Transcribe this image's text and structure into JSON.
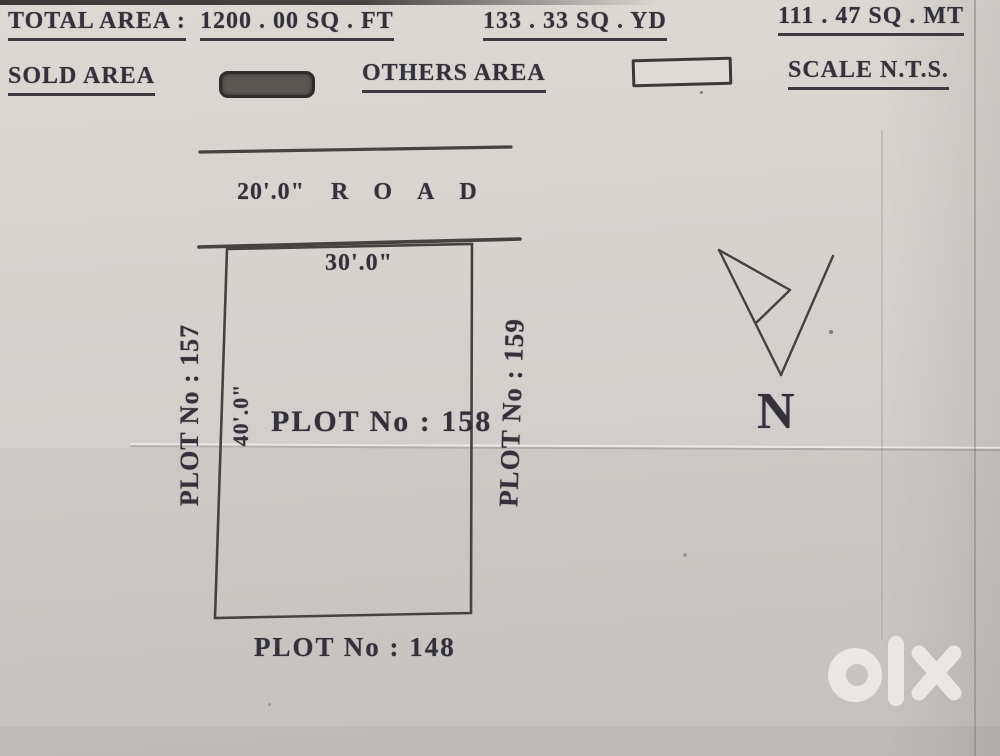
{
  "header": {
    "row1": {
      "total_label": "TOTAL AREA : ",
      "sqft": "1200 . 00 SQ . FT",
      "sqyd": "133 . 33 SQ . YD",
      "sqmt": "111 . 47 SQ . MT"
    },
    "row2": {
      "sold_label": "SOLD AREA",
      "others_label": "OTHERS AREA",
      "scale_label": "SCALE N.T.S."
    }
  },
  "road": {
    "width_dimension": "20'.0\"",
    "name": "ROAD"
  },
  "plot": {
    "main_label": "PLOT No : 158",
    "frontage_dimension": "30'.0\"",
    "depth_dimension": "40'.0\"",
    "left_neighbor": "PLOT No : 157",
    "right_neighbor": "PLOT No : 159",
    "bottom_neighbor": "PLOT No : 148"
  },
  "compass": {
    "north_label": "N"
  },
  "watermark": {
    "brand": "olx"
  },
  "colors": {
    "paper": "#d5d1cd",
    "ink": "#33323a",
    "line": "#45423f",
    "sold_fill": "#5b5753",
    "watermark": "#edebe8"
  }
}
